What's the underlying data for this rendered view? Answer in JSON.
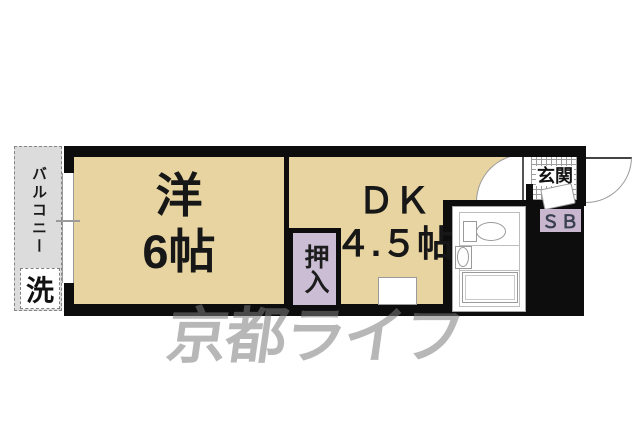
{
  "plan": {
    "balcony": {
      "label": "バルコニー",
      "washer_label": "洗"
    },
    "western_room": {
      "name": "洋",
      "size": "6帖"
    },
    "dining_kitchen": {
      "name": "ＤＫ",
      "size": "４.５帖"
    },
    "closet": {
      "label": "押入"
    },
    "entrance": {
      "label": "玄関"
    },
    "shoe_box": {
      "label": "ＳＢ"
    }
  },
  "watermark": {
    "text": "京都ライフ"
  },
  "colors": {
    "floor_cream": "#e8d4a0",
    "closet_purple": "#cbbdd4",
    "shoebox_purple": "#c8b7cf",
    "balcony_gray": "#dcdcdc",
    "wall_black": "#0d0d0d",
    "watermark_gray": "#7c7c7c"
  }
}
